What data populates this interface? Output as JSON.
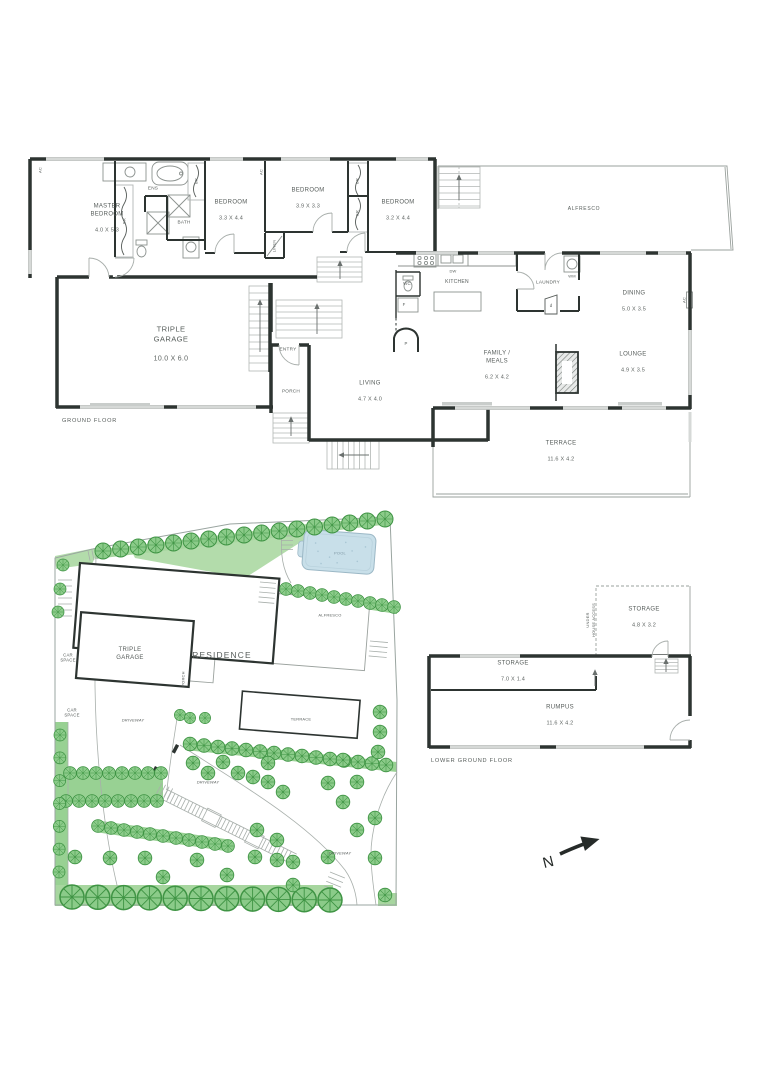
{
  "plan": {
    "ground_floor": {
      "section_label": "GROUND FLOOR",
      "rooms": {
        "master_bedroom": {
          "name": "MASTER\nBEDROOM",
          "dims": "4.0 X 5.3"
        },
        "bedroom_2": {
          "name": "BEDROOM",
          "dims": "3.3 X 4.4"
        },
        "bedroom_3": {
          "name": "BEDROOM",
          "dims": "3.9 X 3.3"
        },
        "bedroom_4": {
          "name": "BEDROOM",
          "dims": "3.2 X 4.4"
        },
        "ensuite": {
          "name": "ENS"
        },
        "bathroom": {
          "name": "BATH"
        },
        "alfresco": {
          "name": "ALFRESCO"
        },
        "triple_garage": {
          "name": "TRIPLE\nGARAGE",
          "dims": "10.0 X 6.0"
        },
        "entry": {
          "name": "ENTRY"
        },
        "porch": {
          "name": "PORCH"
        },
        "living": {
          "name": "LIVING",
          "dims": "4.7 X 4.0"
        },
        "kitchen": {
          "name": "KITCHEN"
        },
        "laundry": {
          "name": "LAUNDRY"
        },
        "dining": {
          "name": "DINING",
          "dims": "5.0 X 3.5"
        },
        "family_meals": {
          "name": "FAMILY /\nMEALS",
          "dims": "6.2 X 4.2"
        },
        "lounge": {
          "name": "LOUNGE",
          "dims": "4.9 X 3.5"
        },
        "terrace": {
          "name": "TERRACE",
          "dims": "11.6 X 4.2"
        }
      },
      "fixture_labels": {
        "linen": "LINEN",
        "robe": "BR",
        "air_con": "AC",
        "wc": "WC",
        "fridge": "F",
        "pantry": "P",
        "dishwasher": "DW",
        "washing_machine": "WM",
        "door": "d"
      }
    },
    "lower_ground_floor": {
      "section_label": "LOWER GROUND FLOOR",
      "rooms": {
        "storage_rear": {
          "name": "STORAGE",
          "dims": "4.8 X 3.2"
        },
        "storage_long": {
          "name": "STORAGE",
          "dims": "7.0 X 1.4"
        },
        "rumpus": {
          "name": "RUMPUS",
          "dims": "11.6 X 4.2"
        }
      },
      "under_house_access": "UNDER\nHOUSE ACCESS"
    },
    "site_plan": {
      "residence": "RESIDENCE",
      "triple_garage": "TRIPLE\nGARAGE",
      "pool": "POOL",
      "alfresco": "ALFRESCO",
      "terrace": "TERRACE",
      "porch": "PORCH",
      "car_space": "CAR\nSPACE",
      "driveway": "DRIVEWAY"
    },
    "compass": {
      "north": "N"
    }
  },
  "colors": {
    "wall": "#2d3431",
    "line_light": "#b2b7b5",
    "text": "#565c5a",
    "tree_green": "#8bcb89",
    "tree_stroke": "#3f9444",
    "grass": "#b3dcab",
    "pool_water": "#c8dfe9"
  }
}
